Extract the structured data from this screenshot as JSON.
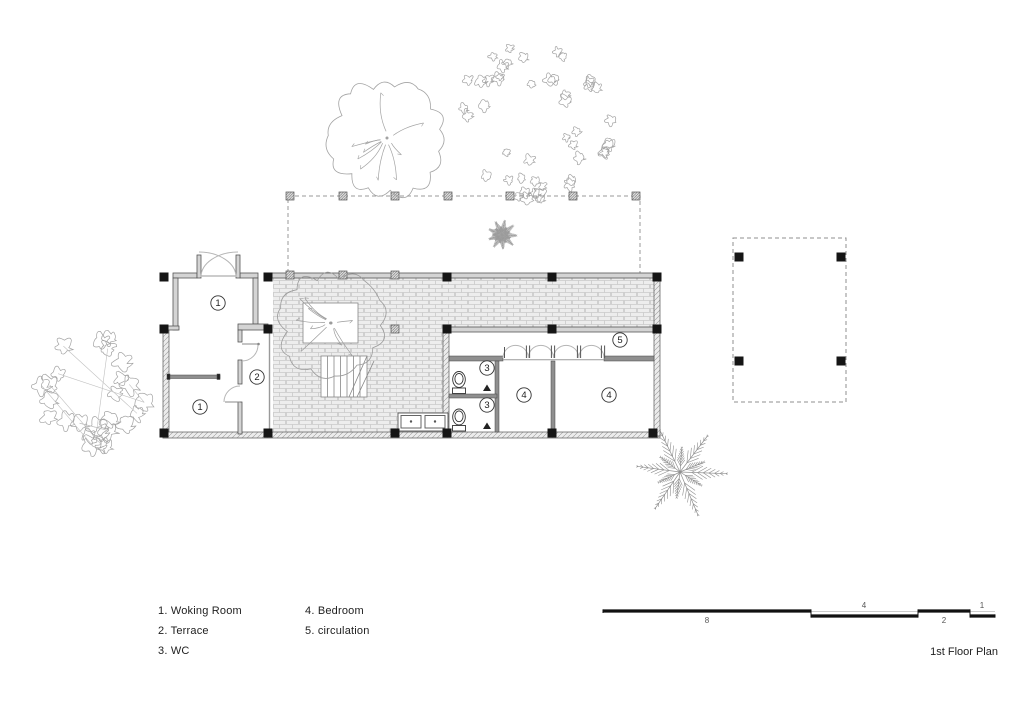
{
  "title": "1st Floor Plan",
  "legend": {
    "columns": [
      {
        "items": [
          "1. Woking Room",
          "2. Terrace",
          "3. WC"
        ]
      },
      {
        "items": [
          "4. Bedroom",
          "5. circulation"
        ]
      }
    ]
  },
  "rooms": [
    {
      "num": "1",
      "name": "Woking Room",
      "cx": 218,
      "cy": 303
    },
    {
      "num": "1",
      "name": "Woking Room",
      "cx": 200,
      "cy": 407
    },
    {
      "num": "2",
      "name": "Terrace",
      "cx": 257,
      "cy": 377
    },
    {
      "num": "3",
      "name": "WC",
      "cx": 487,
      "cy": 368
    },
    {
      "num": "3",
      "name": "WC",
      "cx": 487,
      "cy": 405
    },
    {
      "num": "4",
      "name": "Bedroom",
      "cx": 524,
      "cy": 395
    },
    {
      "num": "4",
      "name": "Bedroom",
      "cx": 609,
      "cy": 395
    },
    {
      "num": "5",
      "name": "circulation",
      "cx": 620,
      "cy": 340
    }
  ],
  "scale_bar": {
    "labels": [
      "8",
      "4",
      "2",
      "1"
    ]
  },
  "colors": {
    "ink": "#1e1e1e",
    "wall_edge": "#555555",
    "wall_fill": "#d4d4d4",
    "interior_wall": "#8f8f8f",
    "brick_line": "#c9c9c9",
    "brick_bg": "#ededed",
    "tree": "#a3a3a3",
    "tree_light": "#c0c0c0",
    "dash": "#999999",
    "column": "#151515"
  }
}
